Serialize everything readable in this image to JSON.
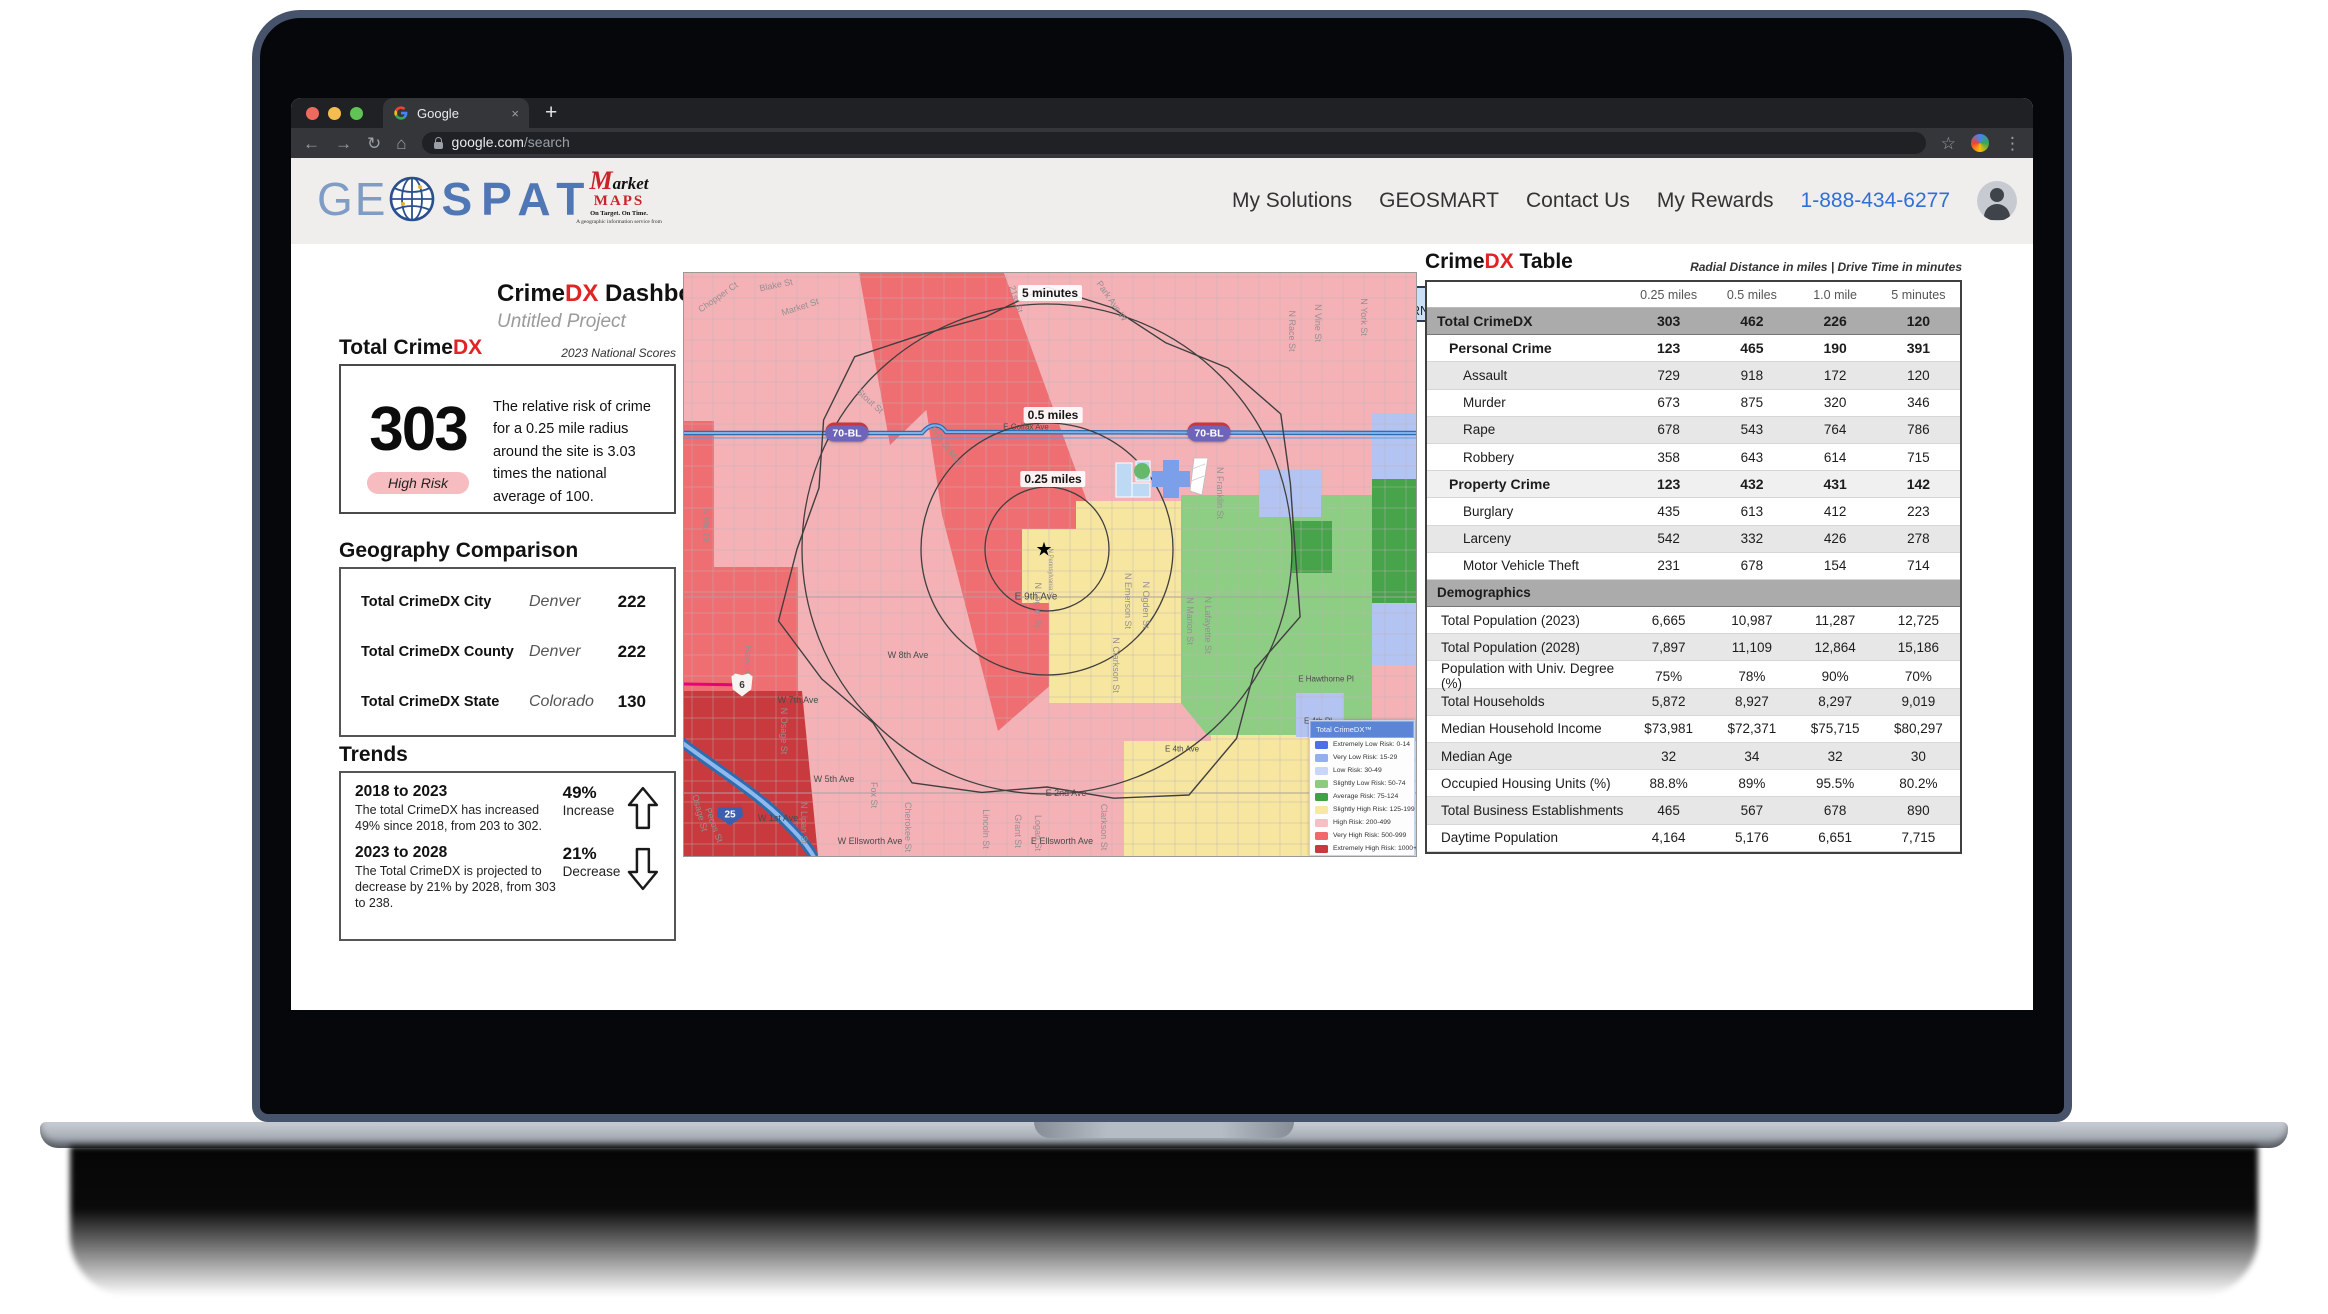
{
  "browser": {
    "tab_title": "Google",
    "url_host": "google.com",
    "url_path": "/search",
    "icons": {
      "back": "←",
      "forward": "→",
      "reload": "↻",
      "home": "⌂",
      "star": "☆",
      "menu": "⋮",
      "plus": "+",
      "close": "×"
    }
  },
  "header": {
    "logo": {
      "ge": "GE",
      "spat": "SPAT"
    },
    "marketmaps": {
      "m": "M",
      "arket": "arket",
      "maps": "MAPS",
      "tagline": "On Target.  On Time.",
      "subline": "A geographic information service from"
    },
    "nav": [
      {
        "label": "My Solutions"
      },
      {
        "label": "GEOSMART"
      },
      {
        "label": "Contact Us"
      },
      {
        "label": "My Rewards"
      }
    ],
    "phone": "1-888-434-6277"
  },
  "dashboard": {
    "title_prefix": "Crime",
    "title_dx": "DX",
    "title_suffix": " Dashboard",
    "subtitle": "Untitled Project"
  },
  "toolbar": {
    "buttons": [
      "DB Options",
      "Area of Interest"
    ],
    "fields": [
      {
        "label": "Street Address:",
        "value": "1807 Telegraph Ave"
      },
      {
        "label": "City:",
        "value": "Oakland"
      },
      {
        "label": "State:",
        "value": "CALIFORNIA"
      },
      {
        "label": "ZIP Code:",
        "value": "94612"
      },
      {
        "label": "Radius:",
        "value": "8 miles"
      }
    ],
    "download_label": "Download"
  },
  "score_panel": {
    "heading_prefix": "Total Crime",
    "heading_dx": "DX",
    "heading_note": "2023 National Scores",
    "score": "303",
    "badge": "High Risk",
    "description": "The relative risk of crime for a 0.25 mile radius around the site is 3.03 times the national average of 100."
  },
  "geography": {
    "heading": "Geography Comparison",
    "rows": [
      {
        "label": "Total CrimeDX City",
        "place": "Denver",
        "value": "222"
      },
      {
        "label": "Total CrimeDX County",
        "place": "Denver",
        "value": "222"
      },
      {
        "label": "Total CrimeDX State",
        "place": "Colorado",
        "value": "130"
      }
    ]
  },
  "trends": {
    "heading": "Trends",
    "items": [
      {
        "title": "2018 to 2023",
        "body": "The total CrimeDX has increased 49% since 2018, from 203 to 302.",
        "pct": "49%",
        "direction_label": "Increase",
        "direction": "up"
      },
      {
        "title": "2023 to 2028",
        "body": "The Total CrimeDX is projected to decrease by 21% by 2028, from 303 to 238.",
        "pct": "21%",
        "direction_label": "Decrease",
        "direction": "down"
      }
    ]
  },
  "map": {
    "ring_labels": [
      {
        "t": "5 minutes",
        "x": 366,
        "y": 20
      },
      {
        "t": "0.5 miles",
        "x": 369,
        "y": 142
      },
      {
        "t": "0.25 miles",
        "x": 369,
        "y": 206
      }
    ],
    "shields": [
      {
        "t": "70-BL",
        "x": 163,
        "y": 159,
        "k": "usalt"
      },
      {
        "t": "70-BL",
        "x": 525,
        "y": 159,
        "k": "usalt"
      },
      {
        "t": "6",
        "x": 58,
        "y": 412,
        "k": "us"
      },
      {
        "t": "25",
        "x": 46,
        "y": 540,
        "k": "i"
      }
    ],
    "street_labels": [
      {
        "t": "Chopper Ct",
        "x": 34,
        "y": 24,
        "r": -35
      },
      {
        "t": "Blake St",
        "x": 92,
        "y": 12,
        "r": -12
      },
      {
        "t": "Market St",
        "x": 116,
        "y": 34,
        "r": -18
      },
      {
        "t": "Stout St",
        "x": 186,
        "y": 128,
        "r": 42
      },
      {
        "t": "16th St Mall",
        "x": 262,
        "y": 172,
        "r": 55
      },
      {
        "t": "21st St",
        "x": 332,
        "y": 26,
        "r": 72
      },
      {
        "t": "Park Ave W",
        "x": 428,
        "y": 28,
        "r": 55
      },
      {
        "t": "N Race St",
        "x": 608,
        "y": 58,
        "r": 90
      },
      {
        "t": "N Vine St",
        "x": 634,
        "y": 50,
        "r": 90
      },
      {
        "t": "N York St",
        "x": 680,
        "y": 44,
        "r": 90
      },
      {
        "t": "N Rio Ct",
        "x": 22,
        "y": 252,
        "r": 90
      },
      {
        "t": "Navajo St",
        "x": 64,
        "y": 392,
        "r": 90
      },
      {
        "t": "N Osage St",
        "x": 100,
        "y": 458,
        "r": 90
      },
      {
        "t": "Osage St",
        "x": 16,
        "y": 540,
        "r": 75
      },
      {
        "t": "Pecos St",
        "x": 30,
        "y": 552,
        "r": 70
      },
      {
        "t": "N Lipan St",
        "x": 120,
        "y": 550,
        "r": 90
      },
      {
        "t": "W 8th Ave",
        "x": 224,
        "y": 382,
        "d": 1
      },
      {
        "t": "W 7th Ave",
        "x": 114,
        "y": 427,
        "d": 1
      },
      {
        "t": "W 5th Ave",
        "x": 150,
        "y": 506,
        "d": 1
      },
      {
        "t": "W 1st Ave",
        "x": 94,
        "y": 545,
        "d": 1
      },
      {
        "t": "W Ellsworth Ave",
        "x": 186,
        "y": 568,
        "d": 1
      },
      {
        "t": "E Ellsworth Ave",
        "x": 378,
        "y": 568,
        "d": 1
      },
      {
        "t": "E 2nd Ave",
        "x": 382,
        "y": 520,
        "d": 1
      },
      {
        "t": "E 9th Ave",
        "x": 352,
        "y": 324,
        "d": 1,
        "s": 10
      },
      {
        "t": "E Colfax Ave",
        "x": 342,
        "y": 154,
        "d": 1,
        "s": 8
      },
      {
        "t": "Fox St",
        "x": 190,
        "y": 522,
        "r": 90
      },
      {
        "t": "Cherokee St",
        "x": 224,
        "y": 554,
        "r": 90
      },
      {
        "t": "Lincoln St",
        "x": 302,
        "y": 556,
        "r": 90
      },
      {
        "t": "Grant St",
        "x": 334,
        "y": 558,
        "r": 90
      },
      {
        "t": "Logan St",
        "x": 354,
        "y": 560,
        "r": 90
      },
      {
        "t": "Clarkson St",
        "x": 420,
        "y": 554,
        "r": 90
      },
      {
        "t": "N Logan St",
        "x": 354,
        "y": 332,
        "r": 90
      },
      {
        "t": "N Clarkson St",
        "x": 432,
        "y": 392,
        "r": 90
      },
      {
        "t": "N Emerson St",
        "x": 444,
        "y": 328,
        "r": 90
      },
      {
        "t": "N Ogden St",
        "x": 462,
        "y": 332,
        "r": 90
      },
      {
        "t": "N Marion St",
        "x": 506,
        "y": 348,
        "r": 90
      },
      {
        "t": "N Lafayette St",
        "x": 524,
        "y": 352,
        "r": 90
      },
      {
        "t": "N Franklin St",
        "x": 536,
        "y": 220,
        "r": 90
      },
      {
        "t": "N Pennsylvania St",
        "x": 366,
        "y": 300,
        "r": 90,
        "s": 6
      },
      {
        "t": "E Hawthorne Pl",
        "x": 642,
        "y": 406,
        "d": 1,
        "s": 8
      },
      {
        "t": "E 4th Pl",
        "x": 634,
        "y": 448,
        "d": 1,
        "s": 8
      },
      {
        "t": "E 4th Ave",
        "x": 498,
        "y": 476,
        "d": 1,
        "s": 8
      }
    ],
    "legend": {
      "title": "Total CrimeDX™",
      "items": [
        {
          "label": "Extremely Low Risk: 0-14",
          "color": "#4d6fe8"
        },
        {
          "label": "Very Low Risk: 15-29",
          "color": "#92aff0"
        },
        {
          "label": "Low Risk: 30-49",
          "color": "#c9d6f7"
        },
        {
          "label": "Slightly Low Risk: 50-74",
          "color": "#8fcb7e"
        },
        {
          "label": "Average Risk: 75-124",
          "color": "#42a047"
        },
        {
          "label": "Slightly High Risk: 125-199",
          "color": "#f6e9a2"
        },
        {
          "label": "High Risk: 200-499",
          "color": "#f6bfc3"
        },
        {
          "label": "Very High Risk: 500-999",
          "color": "#f2696c"
        },
        {
          "label": "Extremely High Risk: 1000+",
          "color": "#c9383c"
        }
      ]
    }
  },
  "crime_table": {
    "heading_prefix": "Crime",
    "heading_dx": "DX",
    "heading_suffix": " Table",
    "heading_note": "Radial Distance in miles | Drive Time in minutes",
    "columns": [
      "0.25 miles",
      "0.5 miles",
      "1.0 mile",
      "5 minutes"
    ],
    "rows": [
      {
        "label": "Total CrimeDX",
        "values": [
          "303",
          "462",
          "226",
          "120"
        ],
        "kind": "total",
        "shaded": false
      },
      {
        "label": "Personal Crime",
        "values": [
          "123",
          "465",
          "190",
          "391"
        ],
        "kind": "section",
        "shaded": false
      },
      {
        "label": "Assault",
        "values": [
          "729",
          "918",
          "172",
          "120"
        ],
        "kind": "item",
        "shaded": true
      },
      {
        "label": "Murder",
        "values": [
          "673",
          "875",
          "320",
          "346"
        ],
        "kind": "item",
        "shaded": false
      },
      {
        "label": "Rape",
        "values": [
          "678",
          "543",
          "764",
          "786"
        ],
        "kind": "item",
        "shaded": true
      },
      {
        "label": "Robbery",
        "values": [
          "358",
          "643",
          "614",
          "715"
        ],
        "kind": "item",
        "shaded": false
      },
      {
        "label": "Property Crime",
        "values": [
          "123",
          "432",
          "431",
          "142"
        ],
        "kind": "section",
        "shaded": true
      },
      {
        "label": "Burglary",
        "values": [
          "435",
          "613",
          "412",
          "223"
        ],
        "kind": "item",
        "shaded": false
      },
      {
        "label": "Larceny",
        "values": [
          "542",
          "332",
          "426",
          "278"
        ],
        "kind": "item",
        "shaded": true
      },
      {
        "label": "Motor Vehicle Theft",
        "values": [
          "231",
          "678",
          "154",
          "714"
        ],
        "kind": "item",
        "shaded": false
      },
      {
        "label": "Demographics",
        "values": [
          "",
          "",
          "",
          ""
        ],
        "kind": "header",
        "shaded": false
      },
      {
        "label": "Total Population (2023)",
        "values": [
          "6,665",
          "10,987",
          "11,287",
          "12,725"
        ],
        "kind": "demo",
        "shaded": false
      },
      {
        "label": "Total Population (2028)",
        "values": [
          "7,897",
          "11,109",
          "12,864",
          "15,186"
        ],
        "kind": "demo",
        "shaded": true
      },
      {
        "label": "Population with Univ. Degree (%)",
        "values": [
          "75%",
          "78%",
          "90%",
          "70%"
        ],
        "kind": "demo",
        "shaded": false
      },
      {
        "label": "Total Households",
        "values": [
          "5,872",
          "8,927",
          "8,297",
          "9,019"
        ],
        "kind": "demo",
        "shaded": true
      },
      {
        "label": "Median Household Income",
        "values": [
          "$73,981",
          "$72,371",
          "$75,715",
          "$80,297"
        ],
        "kind": "demo",
        "shaded": false
      },
      {
        "label": "Median Age",
        "values": [
          "32",
          "34",
          "32",
          "30"
        ],
        "kind": "demo",
        "shaded": true
      },
      {
        "label": "Occupied Housing Units (%)",
        "values": [
          "88.8%",
          "89%",
          "95.5%",
          "80.2%"
        ],
        "kind": "demo",
        "shaded": false
      },
      {
        "label": "Total Business Establishments",
        "values": [
          "465",
          "567",
          "678",
          "890"
        ],
        "kind": "demo",
        "shaded": true
      },
      {
        "label": "Daytime Population",
        "values": [
          "4,164",
          "5,176",
          "6,651",
          "7,715"
        ],
        "kind": "demo",
        "shaded": false
      }
    ]
  }
}
